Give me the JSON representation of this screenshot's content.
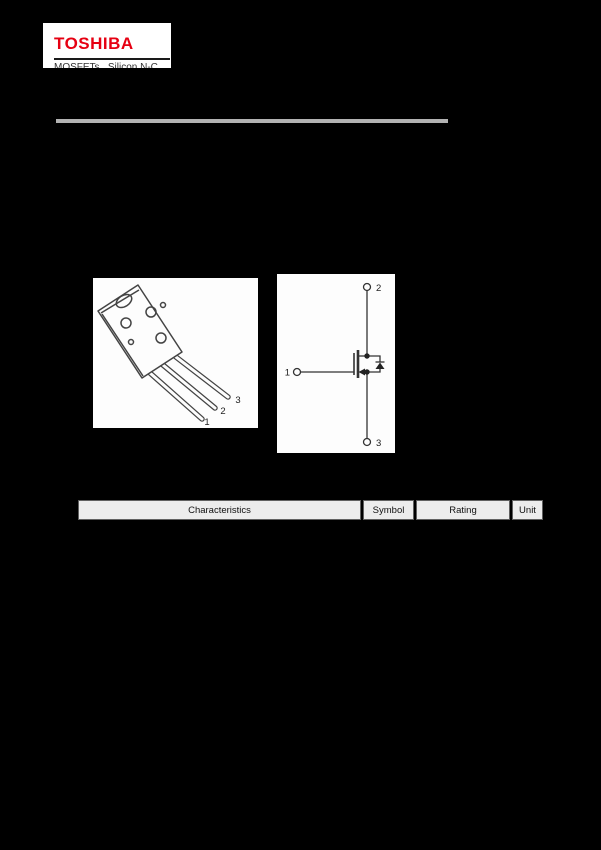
{
  "brand": {
    "logo": "TOSHIBA",
    "tagline_clipped": "MOSFETs   Silicon N-C"
  },
  "figures": {
    "package": {
      "pins": [
        "1",
        "2",
        "3"
      ]
    },
    "schematic": {
      "gate_pin": "1",
      "drain_pin": "2",
      "source_pin": "3"
    }
  },
  "ratings_table": {
    "headers": [
      "Characteristics",
      "Symbol",
      "Rating",
      "Unit"
    ]
  },
  "colors": {
    "page_background": "#000000",
    "brand_red": "#e60012",
    "divider_gray": "#b2b2b2",
    "header_cell_background": "#ececec",
    "line_art": "#444444"
  }
}
